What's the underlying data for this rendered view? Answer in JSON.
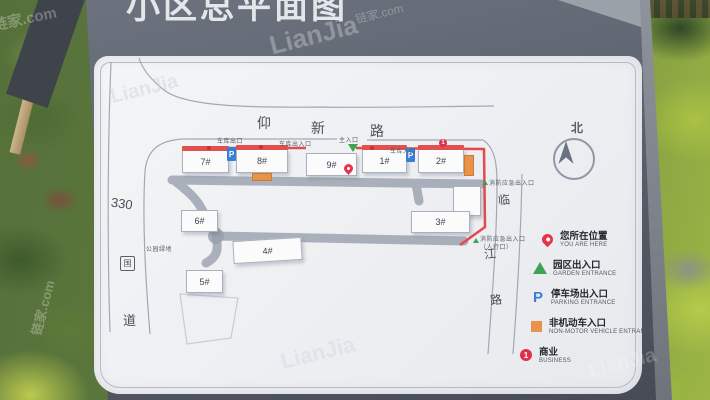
{
  "photo": {
    "watermark_brand": "LianJia",
    "watermark_domain": "链家.com"
  },
  "sign": {
    "title": "小区总平面图"
  },
  "map": {
    "compass_label": "北",
    "roads": {
      "top": [
        "仰",
        "新",
        "路"
      ],
      "left": [
        "330",
        "国",
        "道"
      ],
      "right": [
        "临",
        "江",
        "路"
      ]
    },
    "buildings": [
      {
        "label": "7#"
      },
      {
        "label": "8#"
      },
      {
        "label": "9#"
      },
      {
        "label": "1#"
      },
      {
        "label": "2#"
      },
      {
        "label": "3#"
      },
      {
        "label": "6#"
      },
      {
        "label": "4#"
      },
      {
        "label": "5#"
      }
    ],
    "labels": {
      "garage_exit": "车库出口",
      "garage_entrance_exit": "车库出入口",
      "garage_entrance": "车库入口",
      "main_entrance": "主入口",
      "fire_exit_top": "消防应急出入口",
      "fire_exit_side_line1": "消防应急出入口",
      "fire_exit_side_line2": "（人行口）",
      "park_green": "公园绿地"
    },
    "markers": {
      "parking_letter": "P",
      "business_number": "1"
    },
    "legend": [
      {
        "zh": "您所在位置",
        "en": "YOU ARE HERE"
      },
      {
        "zh": "园区出入口",
        "en": "GARDEN ENTRANCE"
      },
      {
        "zh": "停车场出入口",
        "en": "PARKING ENTRANCE"
      },
      {
        "zh": "非机动车入口",
        "en": "NON-MOTOR VEHICLE ENTRANCE"
      },
      {
        "zh": "商业",
        "en": "BUSINESS"
      }
    ]
  },
  "colors": {
    "boundary_red": "#e24a4e",
    "entrance_green": "#3aa655",
    "parking_blue": "#3a7fd5",
    "nonmotor_orange": "#e8924a",
    "pin_red": "#e8334a",
    "sign_gray": "#5d636e"
  }
}
